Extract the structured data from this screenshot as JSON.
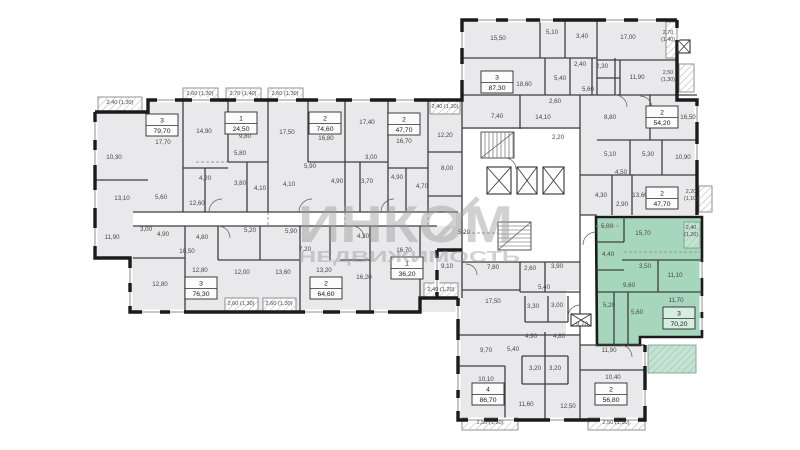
{
  "image_type": "apartment-building-floor-plan",
  "watermark": {
    "line1": "ИНКОМ",
    "line2": "НЕДВИЖИМОСТЬ"
  },
  "selected_apartment": {
    "rooms": "3",
    "area": "70,20"
  },
  "palette": {
    "background": "#ffffff",
    "room_fill": "#e9e9ec",
    "corridor": "#ffffff",
    "wall": "#1b1b1b",
    "inner_wall": "#3f3f3f",
    "highlight": "#a6d7bd",
    "highlight_light": "#c2e4d2",
    "hatch": "#b0b0b0",
    "label": "#474747",
    "window": "#8f8f8f",
    "watermark": "#9a9a9a",
    "box_fill": "#fbfbfb",
    "box_fill_highlight": "#d6eee1",
    "box_border": "#2b2b2b"
  },
  "apartments": [
    {
      "n": "3",
      "a": "79,70",
      "x": 162,
      "y": 125
    },
    {
      "n": "1",
      "a": "24,50",
      "x": 241,
      "y": 123
    },
    {
      "n": "2",
      "a": "74,60",
      "x": 325,
      "y": 123
    },
    {
      "n": "2",
      "a": "47,70",
      "x": 404,
      "y": 124
    },
    {
      "n": "3",
      "a": "87,30",
      "x": 497,
      "y": 82
    },
    {
      "n": "2",
      "a": "54,20",
      "x": 662,
      "y": 117
    },
    {
      "n": "2",
      "a": "47,70",
      "x": 662,
      "y": 198
    },
    {
      "n": "3",
      "a": "70,20",
      "x": 679,
      "y": 318,
      "hl": true
    },
    {
      "n": "1",
      "a": "36,20",
      "x": 407,
      "y": 268
    },
    {
      "n": "2",
      "a": "64,60",
      "x": 326,
      "y": 288
    },
    {
      "n": "3",
      "a": "76,30",
      "x": 201,
      "y": 288
    },
    {
      "n": "4",
      "a": "86,70",
      "x": 488,
      "y": 394
    },
    {
      "n": "2",
      "a": "56,80",
      "x": 611,
      "y": 394
    }
  ],
  "room_labels": [
    {
      "t": "2,40 (1,30)",
      "x": 120,
      "y": 104,
      "s": 5.6
    },
    {
      "t": "2,60 (1,30)",
      "x": 200,
      "y": 95,
      "s": 5.6
    },
    {
      "t": "2,70 (1,40)",
      "x": 243,
      "y": 95,
      "s": 5.6
    },
    {
      "t": "2,60 (1,30)",
      "x": 285,
      "y": 95,
      "s": 5.6
    },
    {
      "t": "2,40 (1,20)",
      "x": 445,
      "y": 108,
      "s": 5.6
    },
    {
      "t": "17,70",
      "x": 163,
      "y": 144
    },
    {
      "t": "14,90",
      "x": 204,
      "y": 133
    },
    {
      "t": "9,80",
      "x": 245,
      "y": 138
    },
    {
      "t": "17,50",
      "x": 287,
      "y": 134
    },
    {
      "t": "16,80",
      "x": 326,
      "y": 140
    },
    {
      "t": "17,40",
      "x": 367,
      "y": 124
    },
    {
      "t": "16,70",
      "x": 404,
      "y": 143
    },
    {
      "t": "12,20",
      "x": 445,
      "y": 137
    },
    {
      "t": "10,30",
      "x": 114,
      "y": 159
    },
    {
      "t": "5,80",
      "x": 240,
      "y": 155
    },
    {
      "t": "5,90",
      "x": 310,
      "y": 168
    },
    {
      "t": "3,00",
      "x": 371,
      "y": 159
    },
    {
      "t": "13,10",
      "x": 122,
      "y": 200
    },
    {
      "t": "5,60",
      "x": 161,
      "y": 199
    },
    {
      "t": "4,20",
      "x": 205,
      "y": 180
    },
    {
      "t": "3,80",
      "x": 240,
      "y": 185
    },
    {
      "t": "4,10",
      "x": 260,
      "y": 190
    },
    {
      "t": "4,10",
      "x": 289,
      "y": 186
    },
    {
      "t": "4,90",
      "x": 337,
      "y": 183
    },
    {
      "t": "3,70",
      "x": 367,
      "y": 183
    },
    {
      "t": "4,90",
      "x": 397,
      "y": 179
    },
    {
      "t": "4,70",
      "x": 422,
      "y": 188
    },
    {
      "t": "12,60",
      "x": 197,
      "y": 205
    },
    {
      "t": "3,00",
      "x": 146,
      "y": 231
    },
    {
      "t": "11,90",
      "x": 112,
      "y": 239
    },
    {
      "t": "4,90",
      "x": 163,
      "y": 236
    },
    {
      "t": "4,80",
      "x": 202,
      "y": 239
    },
    {
      "t": "10,50",
      "x": 187,
      "y": 253
    },
    {
      "t": "5,20",
      "x": 250,
      "y": 232
    },
    {
      "t": "5,90",
      "x": 291,
      "y": 233
    },
    {
      "t": "7,20",
      "x": 305,
      "y": 251
    },
    {
      "t": "4,30",
      "x": 363,
      "y": 238
    },
    {
      "t": "5,20",
      "x": 464,
      "y": 234
    },
    {
      "t": "12,80",
      "x": 160,
      "y": 286
    },
    {
      "t": "12,80",
      "x": 200,
      "y": 272
    },
    {
      "t": "12,00",
      "x": 242,
      "y": 274
    },
    {
      "t": "13,60",
      "x": 283,
      "y": 274
    },
    {
      "t": "13,20",
      "x": 324,
      "y": 272
    },
    {
      "t": "16,20",
      "x": 364,
      "y": 279
    },
    {
      "t": "16,70",
      "x": 404,
      "y": 252
    },
    {
      "t": "2,60 (1,30)",
      "x": 241,
      "y": 305,
      "s": 5.6
    },
    {
      "t": "2,60 (1,30)",
      "x": 279,
      "y": 305,
      "s": 5.6
    },
    {
      "t": "2,40 (1,20)",
      "x": 441,
      "y": 291,
      "s": 5.6
    },
    {
      "t": "15,50",
      "x": 498,
      "y": 40
    },
    {
      "t": "5,10",
      "x": 552,
      "y": 34
    },
    {
      "t": "3,40",
      "x": 582,
      "y": 38
    },
    {
      "t": "17,00",
      "x": 628,
      "y": 39
    },
    {
      "t": "2,70",
      "t2": "(1,40)",
      "x": 668,
      "y": 34,
      "s": 5.4
    },
    {
      "t": "18,60",
      "x": 524,
      "y": 86
    },
    {
      "t": "5,40",
      "x": 560,
      "y": 80
    },
    {
      "t": "2,40",
      "x": 580,
      "y": 66
    },
    {
      "t": "2,30",
      "x": 602,
      "y": 68
    },
    {
      "t": "5,60",
      "x": 588,
      "y": 91
    },
    {
      "t": "11,90",
      "x": 637,
      "y": 79
    },
    {
      "t": "2,50",
      "t2": "(1,30)",
      "x": 668,
      "y": 74,
      "s": 5.4
    },
    {
      "t": "2,60",
      "x": 555,
      "y": 103
    },
    {
      "t": "7,40",
      "x": 497,
      "y": 118
    },
    {
      "t": "14,10",
      "x": 543,
      "y": 119
    },
    {
      "t": "8,80",
      "x": 610,
      "y": 119
    },
    {
      "t": "16,50",
      "x": 688,
      "y": 119
    },
    {
      "t": "2,20",
      "x": 558,
      "y": 139
    },
    {
      "t": "8,00",
      "x": 447,
      "y": 170
    },
    {
      "t": "5,10",
      "x": 610,
      "y": 156
    },
    {
      "t": "5,30",
      "x": 648,
      "y": 156
    },
    {
      "t": "10,90",
      "x": 683,
      "y": 159
    },
    {
      "t": "4,50",
      "x": 621,
      "y": 174
    },
    {
      "t": "4,30",
      "x": 601,
      "y": 197
    },
    {
      "t": "2,90",
      "x": 622,
      "y": 206
    },
    {
      "t": "13,60",
      "x": 640,
      "y": 197
    },
    {
      "t": "2,20",
      "t2": "(1,10)",
      "x": 691,
      "y": 193,
      "s": 5.4
    },
    {
      "t": "5,00",
      "x": 607,
      "y": 228
    },
    {
      "t": "15,70",
      "x": 643,
      "y": 235
    },
    {
      "t": "2,40",
      "t2": "(1,20)",
      "x": 691,
      "y": 229,
      "s": 5.4
    },
    {
      "t": "4,40",
      "x": 608,
      "y": 256
    },
    {
      "t": "3,50",
      "x": 645,
      "y": 268
    },
    {
      "t": "11,10",
      "x": 675,
      "y": 277
    },
    {
      "t": "9,60",
      "x": 629,
      "y": 287
    },
    {
      "t": "5,20",
      "x": 609,
      "y": 307
    },
    {
      "t": "5,60",
      "x": 637,
      "y": 314
    },
    {
      "t": "11,70",
      "x": 676,
      "y": 302
    },
    {
      "t": "9,10",
      "x": 447,
      "y": 268
    },
    {
      "t": "7,80",
      "x": 493,
      "y": 269
    },
    {
      "t": "2,60",
      "x": 530,
      "y": 270
    },
    {
      "t": "3,90",
      "x": 557,
      "y": 268
    },
    {
      "t": "5,40",
      "x": 544,
      "y": 289
    },
    {
      "t": "17,50",
      "x": 493,
      "y": 303
    },
    {
      "t": "3,30",
      "x": 533,
      "y": 308
    },
    {
      "t": "3,00",
      "x": 557,
      "y": 307
    },
    {
      "t": "9,70",
      "x": 582,
      "y": 326
    },
    {
      "t": "4,90",
      "x": 531,
      "y": 338
    },
    {
      "t": "4,80",
      "x": 559,
      "y": 338
    },
    {
      "t": "11,90",
      "x": 609,
      "y": 352
    },
    {
      "t": "9,70",
      "x": 486,
      "y": 352
    },
    {
      "t": "5,40",
      "x": 513,
      "y": 351
    },
    {
      "t": "3,20",
      "x": 535,
      "y": 370
    },
    {
      "t": "3,20",
      "x": 555,
      "y": 370
    },
    {
      "t": "10,10",
      "x": 486,
      "y": 381
    },
    {
      "t": "10,40",
      "x": 613,
      "y": 379
    },
    {
      "t": "11,60",
      "x": 526,
      "y": 406
    },
    {
      "t": "12,50",
      "x": 568,
      "y": 408
    },
    {
      "t": "2,50 (1,30)",
      "x": 490,
      "y": 424,
      "s": 5.6
    },
    {
      "t": "2,50 (1,30)",
      "x": 616,
      "y": 424,
      "s": 5.6
    }
  ],
  "plan": {
    "fills": [
      [
        148,
        100,
        314,
        212,
        "room_fill"
      ],
      [
        95,
        112,
        53,
        146,
        "room_fill"
      ],
      [
        130,
        250,
        18,
        62,
        "room_fill"
      ],
      [
        462,
        20,
        215,
        80,
        "room_fill"
      ],
      [
        462,
        100,
        235,
        115,
        "room_fill"
      ],
      [
        437,
        250,
        145,
        48,
        "room_fill"
      ],
      [
        458,
        298,
        124,
        122,
        "room_fill"
      ],
      [
        582,
        345,
        63,
        75,
        "room_fill"
      ],
      [
        463,
        129,
        117,
        133,
        "corridor"
      ],
      [
        133,
        212,
        323,
        14,
        "corridor"
      ],
      [
        580,
        215,
        16,
        130,
        "corridor"
      ],
      [
        566,
        290,
        14,
        44,
        "corridor"
      ]
    ],
    "outer": [
      "M95 112 H148 V100 H462 V20 H677",
      "M95 112 V258 H130 V312 H420 V298 H458",
      "M677 20 V100 H697 V215",
      "M458 298 V420 H645 V345",
      "M437 250 H462 M437 250 V298"
    ],
    "green_poly": "596,217 702,217 702,337 640,337 640,345 597,345",
    "green_inner": [
      "M596 242 H624",
      "M624 217 V242",
      "M622 260 H702",
      "M658 260 V292",
      "M597 292 H702",
      "M614 292 V345",
      "M628 292 V345",
      "M596 270 H624"
    ],
    "inner": [
      "M183 100 V212",
      "M268 100 V212",
      "M345 100 V212",
      "M388 100 V212",
      "M228 100 V162",
      "M308 100 V162",
      "M428 100 V212",
      "M95 180 H148",
      "M228 162 H268",
      "M308 162 H345",
      "M183 168 H228",
      "M345 162 H388",
      "M388 168 H428",
      "M205 168 V212",
      "M247 162 V212",
      "M360 162 V212",
      "M406 168 V212",
      "M133 212 H458",
      "M133 226 H437",
      "M185 226 V312",
      "M300 226 V312",
      "M370 226 V312",
      "M420 226 V298",
      "M218 226 V260",
      "M260 226 V260",
      "M133 258 H185",
      "M218 260 H300",
      "M330 226 V260",
      "M340 260 H370",
      "M428 152 H462",
      "M428 196 H462",
      "M462 100 V262",
      "M462 262 H580",
      "M580 95 V345",
      "M462 128 H580",
      "M462 95 H697",
      "M462 58 H597",
      "M540 20 V58",
      "M565 20 V58",
      "M545 58 V95",
      "M520 95 V129",
      "M570 58 V95",
      "M592 58 V95",
      "M615 58 V95",
      "M597 20 V95",
      "M597 60 H677",
      "M620 60 V95",
      "M597 78 H620",
      "M650 95 V140",
      "M597 140 H697",
      "M630 140 V175",
      "M662 140 V175",
      "M580 175 H697",
      "M612 175 V215",
      "M632 175 V215",
      "M580 215 H597",
      "M462 262 V298",
      "M520 262 V292",
      "M545 262 V292",
      "M462 290 H520",
      "M520 292 H580",
      "M525 296 V322",
      "M548 296 V322",
      "M568 296 V322",
      "M525 322 H568",
      "M458 335 H580",
      "M522 356 H568",
      "M522 384 H568",
      "M522 356 V384",
      "M568 356 V384",
      "M545 356 V384",
      "M545 332 V356",
      "M545 384 V420",
      "M458 366 H505",
      "M505 366 V420",
      "M580 345 H645",
      "M580 345 V420",
      "M580 370 H645"
    ],
    "dashed": [
      "M268 212 V226",
      "M345 212 V226",
      "M428 212 V226",
      "M596 226 H620",
      "M462 233 H520",
      "M196 162 H228",
      "M624 252 H700"
    ],
    "balconies": [
      [
        98,
        97,
        44,
        15
      ],
      [
        183,
        88,
        35,
        12
      ],
      [
        226,
        88,
        35,
        12
      ],
      [
        268,
        88,
        35,
        12
      ],
      [
        430,
        101,
        30,
        13
      ],
      [
        225,
        298,
        33,
        13
      ],
      [
        263,
        298,
        33,
        13
      ],
      [
        424,
        283,
        34,
        14
      ],
      [
        666,
        22,
        11,
        36
      ],
      [
        679,
        64,
        15,
        28
      ],
      [
        699,
        186,
        13,
        26
      ],
      [
        462,
        418,
        56,
        12
      ],
      [
        588,
        418,
        57,
        12
      ]
    ],
    "green_balconies": [
      [
        684,
        222,
        16,
        26
      ],
      [
        648,
        345,
        48,
        28
      ]
    ],
    "stairs": [
      {
        "x": 481,
        "y": 132,
        "w": 33,
        "h": 26,
        "o": "h"
      },
      {
        "x": 498,
        "y": 222,
        "w": 33,
        "h": 28,
        "o": "v"
      }
    ],
    "elevators": [
      [
        487,
        167,
        24,
        27
      ],
      [
        517,
        167,
        20,
        27
      ],
      [
        543,
        167,
        21,
        27
      ],
      [
        678,
        40,
        12,
        13
      ],
      [
        571,
        314,
        20,
        12
      ]
    ],
    "windows": [
      [
        157,
        100,
        18,
        "h"
      ],
      [
        192,
        100,
        18,
        "h"
      ],
      [
        236,
        100,
        18,
        "h"
      ],
      [
        278,
        100,
        18,
        "h"
      ],
      [
        318,
        100,
        18,
        "h"
      ],
      [
        352,
        100,
        18,
        "h"
      ],
      [
        396,
        100,
        18,
        "h"
      ],
      [
        478,
        20,
        18,
        "h"
      ],
      [
        508,
        20,
        18,
        "h"
      ],
      [
        540,
        20,
        13,
        "h"
      ],
      [
        606,
        20,
        18,
        "h"
      ],
      [
        638,
        20,
        18,
        "h"
      ],
      [
        142,
        312,
        18,
        "h"
      ],
      [
        170,
        312,
        14,
        "h"
      ],
      [
        305,
        312,
        18,
        "h"
      ],
      [
        340,
        312,
        16,
        "h"
      ],
      [
        374,
        312,
        14,
        "h"
      ],
      [
        468,
        420,
        16,
        "h"
      ],
      [
        498,
        420,
        16,
        "h"
      ],
      [
        550,
        420,
        14,
        "h"
      ],
      [
        600,
        420,
        14,
        "h"
      ],
      [
        626,
        420,
        12,
        "h"
      ],
      [
        95,
        122,
        18,
        "v"
      ],
      [
        95,
        150,
        15,
        "v"
      ],
      [
        95,
        190,
        18,
        "v"
      ],
      [
        95,
        228,
        18,
        "v"
      ],
      [
        130,
        268,
        15,
        "v"
      ],
      [
        130,
        292,
        14,
        "v"
      ],
      [
        458,
        306,
        13,
        "v"
      ],
      [
        458,
        340,
        16,
        "v"
      ],
      [
        458,
        374,
        16,
        "v"
      ],
      [
        458,
        398,
        13,
        "v"
      ],
      [
        645,
        352,
        14,
        "v"
      ],
      [
        645,
        390,
        16,
        "v"
      ],
      [
        462,
        32,
        16,
        "v"
      ],
      [
        462,
        64,
        16,
        "v"
      ],
      [
        697,
        106,
        16,
        "v"
      ],
      [
        697,
        144,
        16,
        "v"
      ],
      [
        702,
        262,
        16,
        "v"
      ],
      [
        702,
        296,
        16,
        "v"
      ],
      [
        702,
        318,
        12,
        "v"
      ],
      [
        677,
        28,
        12,
        "v"
      ],
      [
        437,
        258,
        12,
        "v"
      ],
      [
        437,
        280,
        12,
        "v"
      ]
    ],
    "doors": [
      "M209 212 a13 13 0 0 1 13 -13",
      "M299 212 a13 13 0 0 1 13 -13",
      "M381 212 a13 13 0 0 1 13 -13",
      "M218 226 a12 12 0 0 1 12 12",
      "M352 226 a12 12 0 0 1 12 12",
      "M596 232 a13 13 0 0 0 -13 13",
      "M580 305 a12 12 0 0 0 -12 12",
      "M615 95 a12 12 0 0 1 12 12",
      "M505 158 a11 11 0 0 1 11 11",
      "M466 264 a11 11 0 0 1 11 11",
      "M620 345 a12 12 0 0 1 12 12",
      "M640 96 a12 12 0 0 1 12 12"
    ]
  }
}
